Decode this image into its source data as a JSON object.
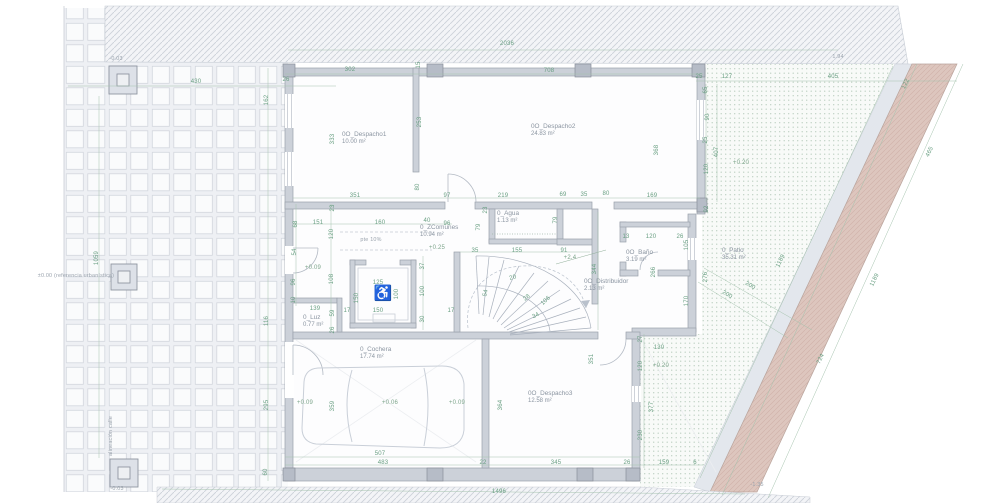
{
  "colors": {
    "dimension_green": "#699f82",
    "note_grey": "#9aa3ad",
    "wall_grey": "#ccd1d9",
    "pink_band": "#ddc6be",
    "patio_dot_green": "#bccfc1",
    "paper_white": "#ffffff"
  },
  "symbols": {
    "wheelchair": "♿"
  },
  "rooms": [
    {
      "name": "0O_Despacho1",
      "area": "10.00 m²",
      "x": 342,
      "y": 131
    },
    {
      "name": "0O_Despacho2",
      "area": "24.83 m²",
      "x": 531,
      "y": 123
    },
    {
      "name": "0_ZComunes",
      "area": "10.94 m²",
      "x": 420,
      "y": 224
    },
    {
      "name": "0_Agua",
      "area": "1.13  m²",
      "x": 497,
      "y": 210
    },
    {
      "name": "0_Luz",
      "area": "0.77  m²",
      "x": 303,
      "y": 314
    },
    {
      "name": "0O_Baño",
      "area": "3.19  m²",
      "x": 626,
      "y": 249
    },
    {
      "name": "0O_Distribuidor",
      "area": "2.13  m²",
      "x": 584,
      "y": 278
    },
    {
      "name": "0_Patio",
      "area": "35.31 m²",
      "x": 722,
      "y": 247
    },
    {
      "name": "0_Cochera",
      "area": "17.74 m²",
      "x": 360,
      "y": 346
    },
    {
      "name": "0O_Despacho3",
      "area": "12.58 m²",
      "x": 528,
      "y": 390
    }
  ],
  "dims": [
    {
      "t": "2036",
      "x": 507,
      "y": 44,
      "r": 0
    },
    {
      "t": "430",
      "x": 196,
      "y": 82,
      "r": 0
    },
    {
      "t": "26",
      "x": 286,
      "y": 80,
      "r": 0
    },
    {
      "t": "302",
      "x": 350,
      "y": 70,
      "r": 0
    },
    {
      "t": "708",
      "x": 549,
      "y": 71,
      "r": 0
    },
    {
      "t": "25",
      "x": 699,
      "y": 77,
      "r": 0
    },
    {
      "t": "127",
      "x": 727,
      "y": 77,
      "r": 0
    },
    {
      "t": "405",
      "x": 833,
      "y": 77,
      "r": 0
    },
    {
      "t": "15",
      "x": 419,
      "y": 65,
      "r": -90
    },
    {
      "t": "162",
      "x": 267,
      "y": 100,
      "r": -90
    },
    {
      "t": "333",
      "x": 333,
      "y": 139,
      "r": -90
    },
    {
      "t": "253",
      "x": 420,
      "y": 122,
      "r": -90
    },
    {
      "t": "368",
      "x": 657,
      "y": 150,
      "r": -90
    },
    {
      "t": "65",
      "x": 706,
      "y": 90,
      "r": -90
    },
    {
      "t": "90",
      "x": 708,
      "y": 117,
      "r": -90
    },
    {
      "t": "25",
      "x": 706,
      "y": 140,
      "r": -90
    },
    {
      "t": "407",
      "x": 717,
      "y": 152,
      "r": -90
    },
    {
      "t": "120",
      "x": 707,
      "y": 169,
      "r": -90
    },
    {
      "t": "122",
      "x": 906,
      "y": 84,
      "r": -64
    },
    {
      "t": "465",
      "x": 930,
      "y": 152,
      "r": -64
    },
    {
      "t": "80",
      "x": 418,
      "y": 187,
      "r": -90
    },
    {
      "t": "351",
      "x": 355,
      "y": 196,
      "r": 0
    },
    {
      "t": "97",
      "x": 447,
      "y": 196,
      "r": 0
    },
    {
      "t": "219",
      "x": 503,
      "y": 196,
      "r": 0
    },
    {
      "t": "69",
      "x": 563,
      "y": 195,
      "r": 0
    },
    {
      "t": "35",
      "x": 584,
      "y": 195,
      "r": 0
    },
    {
      "t": "80",
      "x": 606,
      "y": 194,
      "r": 0
    },
    {
      "t": "169",
      "x": 652,
      "y": 196,
      "r": 0
    },
    {
      "t": "92",
      "x": 707,
      "y": 209,
      "r": -90
    },
    {
      "t": "23",
      "x": 333,
      "y": 208,
      "r": -90
    },
    {
      "t": "151",
      "x": 318,
      "y": 223,
      "r": 0
    },
    {
      "t": "160",
      "x": 380,
      "y": 223,
      "r": 0
    },
    {
      "t": "40",
      "x": 427,
      "y": 221,
      "r": 0
    },
    {
      "t": "96",
      "x": 447,
      "y": 224,
      "r": 0
    },
    {
      "t": "120",
      "x": 332,
      "y": 234,
      "r": -90
    },
    {
      "t": "68",
      "x": 296,
      "y": 224,
      "r": -90
    },
    {
      "t": "54",
      "x": 295,
      "y": 252,
      "r": -90
    },
    {
      "t": "96",
      "x": 294,
      "y": 282,
      "r": -90
    },
    {
      "t": "10",
      "x": 294,
      "y": 300,
      "r": -90
    },
    {
      "t": "108",
      "x": 332,
      "y": 279,
      "r": -90
    },
    {
      "t": "139",
      "x": 315,
      "y": 309,
      "r": 0
    },
    {
      "t": "59",
      "x": 333,
      "y": 313,
      "r": -90
    },
    {
      "t": "116",
      "x": 267,
      "y": 321,
      "r": -90
    },
    {
      "t": "125",
      "x": 378,
      "y": 283,
      "r": 0
    },
    {
      "t": "150",
      "x": 357,
      "y": 298,
      "r": -90
    },
    {
      "t": "100",
      "x": 397,
      "y": 294,
      "r": -90
    },
    {
      "t": "150",
      "x": 378,
      "y": 311,
      "r": 0
    },
    {
      "t": "17",
      "x": 347,
      "y": 311,
      "r": 0
    },
    {
      "t": "17",
      "x": 451,
      "y": 311,
      "r": 0
    },
    {
      "t": "37",
      "x": 423,
      "y": 266,
      "r": -90
    },
    {
      "t": "100",
      "x": 423,
      "y": 291,
      "r": -90
    },
    {
      "t": "30",
      "x": 423,
      "y": 319,
      "r": -90
    },
    {
      "t": "26",
      "x": 333,
      "y": 330,
      "r": -90
    },
    {
      "t": "23",
      "x": 486,
      "y": 210,
      "r": -90
    },
    {
      "t": "79",
      "x": 479,
      "y": 227,
      "r": -90
    },
    {
      "t": "79",
      "x": 556,
      "y": 220,
      "r": -90
    },
    {
      "t": "35",
      "x": 475,
      "y": 251,
      "r": 0
    },
    {
      "t": "155",
      "x": 517,
      "y": 251,
      "r": 0
    },
    {
      "t": "91",
      "x": 564,
      "y": 251,
      "r": 0
    },
    {
      "t": "344",
      "x": 595,
      "y": 269,
      "r": -90
    },
    {
      "t": "20",
      "x": 513,
      "y": 278,
      "r": -14
    },
    {
      "t": "54",
      "x": 486,
      "y": 293,
      "r": -78
    },
    {
      "t": "28",
      "x": 527,
      "y": 298,
      "r": -38
    },
    {
      "t": "106",
      "x": 546,
      "y": 301,
      "r": -44
    },
    {
      "t": "34",
      "x": 536,
      "y": 316,
      "r": -26
    },
    {
      "t": "13",
      "x": 626,
      "y": 237,
      "r": 0
    },
    {
      "t": "120",
      "x": 651,
      "y": 237,
      "r": 0
    },
    {
      "t": "26",
      "x": 680,
      "y": 237,
      "r": 0
    },
    {
      "t": "105",
      "x": 687,
      "y": 245,
      "r": -90
    },
    {
      "t": "266",
      "x": 654,
      "y": 272,
      "r": -90
    },
    {
      "t": "170",
      "x": 687,
      "y": 301,
      "r": -90
    },
    {
      "t": "276",
      "x": 706,
      "y": 277,
      "r": -90
    },
    {
      "t": "1189",
      "x": 781,
      "y": 261,
      "r": -64
    },
    {
      "t": "1189",
      "x": 875,
      "y": 280,
      "r": -64
    },
    {
      "t": "724",
      "x": 821,
      "y": 359,
      "r": -64
    },
    {
      "t": "200",
      "x": 750,
      "y": 286,
      "r": 31
    },
    {
      "t": "200",
      "x": 727,
      "y": 295,
      "r": 31
    },
    {
      "t": "27",
      "x": 641,
      "y": 339,
      "r": -90
    },
    {
      "t": "130",
      "x": 659,
      "y": 348,
      "r": 0
    },
    {
      "t": "120",
      "x": 641,
      "y": 366,
      "r": -90
    },
    {
      "t": "377",
      "x": 652,
      "y": 407,
      "r": -90
    },
    {
      "t": "230",
      "x": 641,
      "y": 435,
      "r": -90
    },
    {
      "t": "359",
      "x": 333,
      "y": 406,
      "r": -90
    },
    {
      "t": "364",
      "x": 501,
      "y": 405,
      "r": -90
    },
    {
      "t": "351",
      "x": 592,
      "y": 359,
      "r": -90
    },
    {
      "t": "507",
      "x": 380,
      "y": 454,
      "r": 0
    },
    {
      "t": "483",
      "x": 383,
      "y": 463,
      "r": 0
    },
    {
      "t": "22",
      "x": 483,
      "y": 463,
      "r": 0
    },
    {
      "t": "345",
      "x": 556,
      "y": 463,
      "r": 0
    },
    {
      "t": "26",
      "x": 627,
      "y": 463,
      "r": 0
    },
    {
      "t": "159",
      "x": 664,
      "y": 463,
      "r": 0
    },
    {
      "t": "6",
      "x": 695,
      "y": 463,
      "r": 0
    },
    {
      "t": "1496",
      "x": 499,
      "y": 492,
      "r": 0
    },
    {
      "t": "295",
      "x": 267,
      "y": 405,
      "r": -90
    },
    {
      "t": "60",
      "x": 266,
      "y": 472,
      "r": -90
    },
    {
      "t": "1059",
      "x": 97,
      "y": 258,
      "r": -90
    }
  ],
  "levels": [
    {
      "t": "+0.25",
      "x": 437,
      "y": 248,
      "r": 0
    },
    {
      "t": "+0.09",
      "x": 313,
      "y": 268,
      "r": 0
    },
    {
      "t": "+2.4",
      "x": 570,
      "y": 258,
      "r": 0
    },
    {
      "t": "+0.20",
      "x": 741,
      "y": 163,
      "r": 0
    },
    {
      "t": "+0.20",
      "x": 661,
      "y": 366,
      "r": 0
    },
    {
      "t": "+0.09",
      "x": 305,
      "y": 403,
      "r": 0
    },
    {
      "t": "+0.06",
      "x": 390,
      "y": 403,
      "r": 0
    },
    {
      "t": "+0.09",
      "x": 457,
      "y": 403,
      "r": 0
    }
  ],
  "notes": [
    {
      "t": "-0.03",
      "x": 116,
      "y": 59,
      "r": 0
    },
    {
      "t": "-0.03",
      "x": 117,
      "y": 489,
      "r": 0
    },
    {
      "t": "±0.00 (referencia urbanística)",
      "x": 76,
      "y": 276,
      "r": 0
    },
    {
      "t": "alineación calle",
      "x": 111,
      "y": 436,
      "r": -90
    },
    {
      "t": "pte 10%",
      "x": 371,
      "y": 240,
      "r": 0
    },
    {
      "t": "-1.35",
      "x": 757,
      "y": 485,
      "r": 0
    },
    {
      "t": "1.94",
      "x": 838,
      "y": 57,
      "r": 0
    }
  ]
}
